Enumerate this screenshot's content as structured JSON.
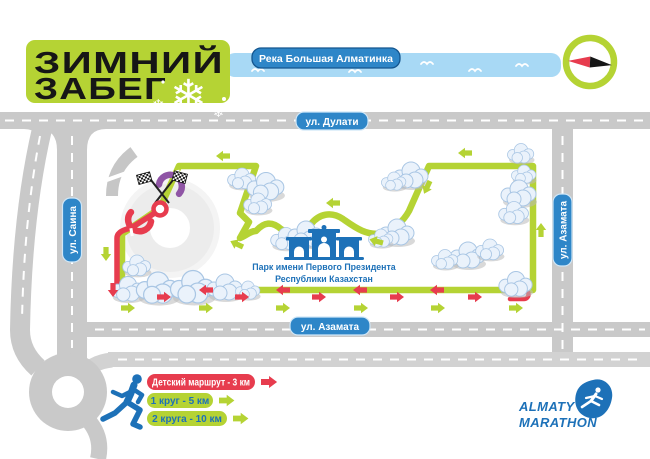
{
  "title": {
    "line1": "ЗИМНИЙ",
    "line2": "ЗАБЕГ",
    "snowflake_icon": "❄"
  },
  "map": {
    "river_label": "Река Большая Алматинка",
    "streets": {
      "top": "ул. Дулати",
      "left": "ул. Саина",
      "right": "ул. Азамата",
      "bottom": "ул. Азамата"
    },
    "park": {
      "line1": "Парк имени Первого Президента",
      "line2": "Республики Казахстан"
    }
  },
  "legend": {
    "items": [
      {
        "label": "Детский маршрут - 3 км",
        "badge_color": "#e73c4e",
        "text_color": "#ffffff"
      },
      {
        "label": "1 круг - 5 км",
        "badge_color": "#b5d334",
        "text_color": "#1d71b8"
      },
      {
        "label": "2 круга - 10 км",
        "badge_color": "#b5d334",
        "text_color": "#1d71b8"
      }
    ]
  },
  "logo": {
    "line1": "ALMATY",
    "line2": "MARATHON"
  },
  "icons": {
    "compass": "green-ring-with-red-black-needle",
    "start_finish": "crossed-checkered-flags",
    "park": "blue-gate-with-arches",
    "trees": "cloud-shaped-bushes"
  },
  "colors": {
    "route_green": "#b5d334",
    "route_red": "#e73c4e",
    "arch_purple": "#8f55a5",
    "river_blue": "#a8d9f5",
    "label_blue": "#2e86c8",
    "label_border": "#cfe6f7",
    "river_label_border": "#14568f",
    "road_gray": "#c9c9c9",
    "road_light": "#d2d2d2",
    "park_blue": "#1d71b8",
    "title_green": "#b5d334",
    "black": "#161616",
    "white": "#ffffff"
  }
}
